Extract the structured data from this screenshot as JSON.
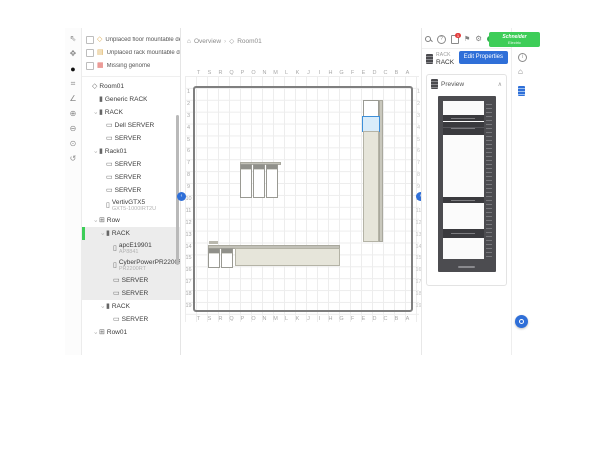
{
  "brand": {
    "line1": "Schneider",
    "line2": "Electric",
    "color": "#3dcd58"
  },
  "header": {
    "icons": [
      {
        "name": "search",
        "kind": "mag"
      },
      {
        "name": "help",
        "kind": "help",
        "glyph": "?"
      },
      {
        "name": "export",
        "kind": "export",
        "badge": "1"
      },
      {
        "name": "flag",
        "kind": "flag",
        "glyph": "⚑"
      },
      {
        "name": "settings",
        "kind": "gear",
        "glyph": "⚙"
      },
      {
        "name": "status",
        "kind": "status"
      }
    ]
  },
  "left_toolbar": {
    "tools": [
      {
        "name": "select-tool",
        "glyph": "⇖"
      },
      {
        "name": "pan-tool",
        "glyph": "✥"
      },
      {
        "name": "add-tool",
        "glyph": "●",
        "active": true
      },
      {
        "name": "measure-tool",
        "glyph": "⌗"
      },
      {
        "name": "angle-tool",
        "glyph": "∠"
      },
      {
        "name": "zoom-in-tool",
        "glyph": "⊕"
      },
      {
        "name": "zoom-out-tool",
        "glyph": "⊖"
      },
      {
        "name": "zoom-fit-tool",
        "glyph": "⊙"
      },
      {
        "name": "history-tool",
        "glyph": "↺"
      }
    ]
  },
  "sidebar": {
    "filters": [
      {
        "label": "Unplaced floor mountable devices",
        "icon": "floor-device",
        "glyph": "◇",
        "icon_color": "#dba94e"
      },
      {
        "label": "Unplaced rack mountable devices",
        "icon": "rack-device",
        "glyph": "▤",
        "icon_color": "#dba94e"
      },
      {
        "label": "Missing genome",
        "icon": "genome",
        "glyph": "▦",
        "icon_color": "#e0635c"
      }
    ],
    "tree": [
      {
        "label": "Room01",
        "depth": 0,
        "icon": "room",
        "glyph": "◇",
        "caret": false
      },
      {
        "label": "Generic RACK",
        "depth": 1,
        "icon": "rack",
        "glyph": "▮",
        "caret": false
      },
      {
        "label": "RACK",
        "depth": 1,
        "icon": "rack",
        "glyph": "▮",
        "caret": true
      },
      {
        "label": "Dell SERVER",
        "depth": 2,
        "icon": "server",
        "glyph": "▭",
        "caret": false
      },
      {
        "label": "SERVER",
        "depth": 2,
        "icon": "server",
        "glyph": "▭",
        "caret": false
      },
      {
        "label": "Rack01",
        "depth": 1,
        "icon": "rack",
        "glyph": "▮",
        "caret": true
      },
      {
        "label": "SERVER",
        "depth": 2,
        "icon": "server",
        "glyph": "▭",
        "caret": false
      },
      {
        "label": "SERVER",
        "depth": 2,
        "icon": "server",
        "glyph": "▭",
        "caret": false
      },
      {
        "label": "SERVER",
        "depth": 2,
        "icon": "server",
        "glyph": "▭",
        "caret": false
      },
      {
        "label": "VertivGTX5",
        "sub": "GXT5-1000IRT2U",
        "depth": 2,
        "icon": "device",
        "glyph": "▯",
        "caret": false
      },
      {
        "label": "Row",
        "depth": 1,
        "icon": "row",
        "glyph": "⊞",
        "caret": true
      },
      {
        "label": "RACK",
        "depth": 2,
        "icon": "rack",
        "glyph": "▮",
        "caret": true,
        "selected": true,
        "in_selection": true
      },
      {
        "label": "apcE19901",
        "sub": "AP8841",
        "depth": 3,
        "icon": "device",
        "glyph": "▯",
        "in_selection": true
      },
      {
        "label": "CyberPowerPR2200R...",
        "sub": "PR2200RT",
        "depth": 3,
        "icon": "device",
        "glyph": "▯",
        "in_selection": true
      },
      {
        "label": "SERVER",
        "depth": 3,
        "icon": "server",
        "glyph": "▭",
        "in_selection": true
      },
      {
        "label": "SERVER",
        "depth": 3,
        "icon": "server",
        "glyph": "▭",
        "in_selection": true
      },
      {
        "label": "RACK",
        "depth": 2,
        "icon": "rack",
        "glyph": "▮",
        "caret": true
      },
      {
        "label": "SERVER",
        "depth": 3,
        "icon": "server",
        "glyph": "▭",
        "caret": false
      },
      {
        "label": "Row01",
        "depth": 1,
        "icon": "row",
        "glyph": "⊞",
        "caret": true
      }
    ]
  },
  "breadcrumb": {
    "home_icon": "⌂",
    "overview": "Overview",
    "separator": "›",
    "room_icon": "◇",
    "current": "Room01"
  },
  "floor": {
    "columns": [
      "T",
      "S",
      "R",
      "Q",
      "P",
      "O",
      "N",
      "M",
      "L",
      "K",
      "J",
      "I",
      "H",
      "G",
      "F",
      "E",
      "D",
      "C",
      "B",
      "A"
    ],
    "rows": [
      "1",
      "2",
      "3",
      "4",
      "5",
      "6",
      "7",
      "8",
      "9",
      "10",
      "11",
      "12",
      "13",
      "14",
      "15",
      "16",
      "17",
      "18",
      "19"
    ]
  },
  "properties": {
    "type_label": "RACK",
    "name": "RACK",
    "edit_button": "Edit Properties"
  },
  "preview": {
    "title": "Preview",
    "collapse_glyph": "∧"
  }
}
